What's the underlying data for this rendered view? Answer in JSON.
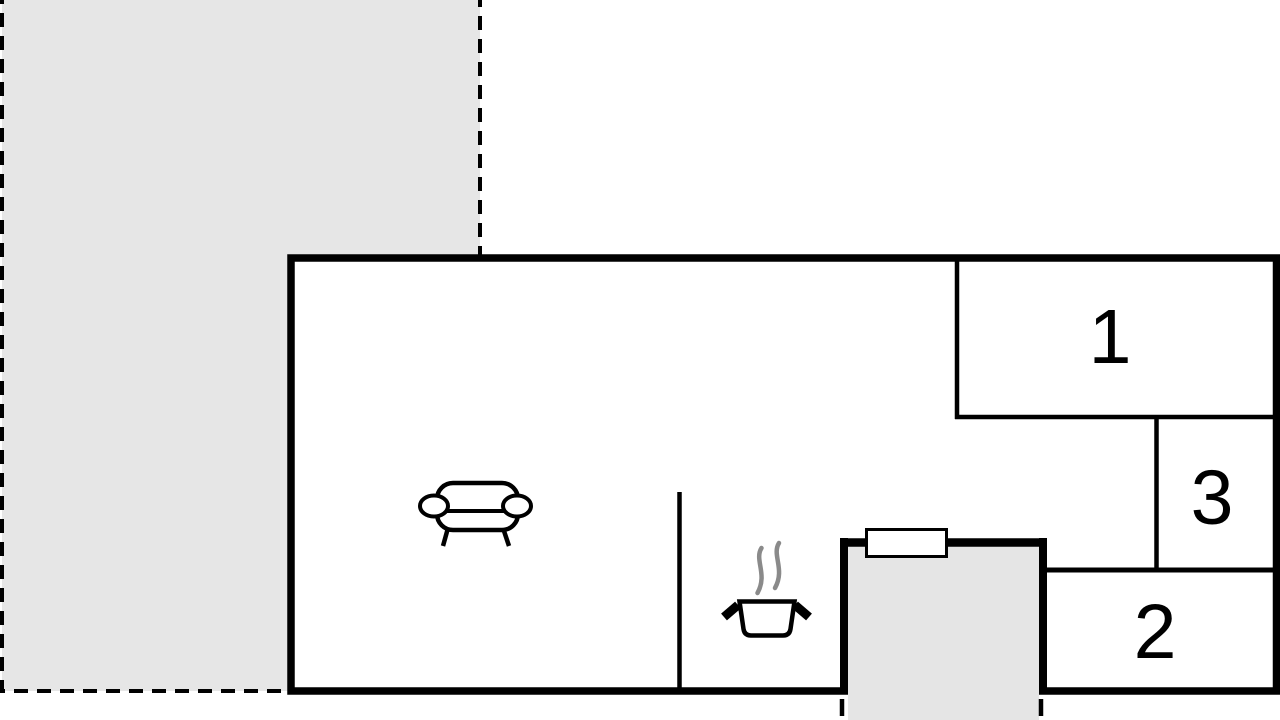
{
  "floorplan": {
    "rooms": {
      "room1": {
        "label": "1"
      },
      "room2": {
        "label": "2"
      },
      "room3": {
        "label": "3"
      }
    },
    "areas": {
      "terrace": {
        "name": "terrace"
      },
      "entrance_porch": {
        "name": "entrance-porch"
      }
    },
    "icons": [
      {
        "name": "sofa-icon"
      },
      {
        "name": "cooking-pot-icon"
      },
      {
        "name": "steam-icon"
      },
      {
        "name": "window-icon"
      }
    ],
    "colors": {
      "wall": "#000000",
      "terrace_fill": "#e6e6e6",
      "porch_fill": "#e5e5e5",
      "steam": "#8a8a8a",
      "background": "#ffffff"
    }
  }
}
